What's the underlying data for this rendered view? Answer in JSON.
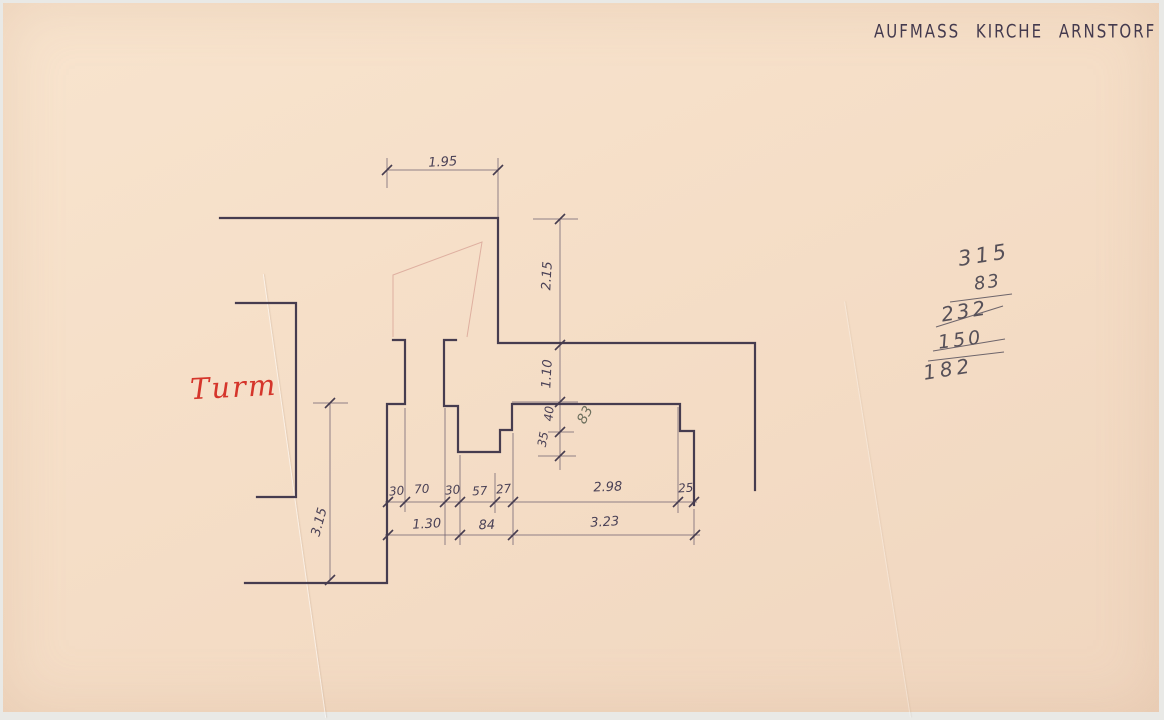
{
  "title": "AUFMASS KIRCHE ARNSTORF",
  "annotations": {
    "room_label": "Turm"
  },
  "calculation": {
    "lines": [
      {
        "text": "315"
      },
      {
        "text": "83"
      },
      {
        "text": "232"
      },
      {
        "text": "150"
      },
      {
        "text": "182"
      }
    ]
  },
  "colors": {
    "paper": "#f5dec7",
    "ink": "#463c4f",
    "dim_line": "#6e6070",
    "dim_text": "#4a4156",
    "pencil": "#57515c",
    "pencil_light": "#6e705e",
    "red": "#d5352b",
    "sketch": "#c4766e"
  },
  "drawing": {
    "walls": [
      [
        [
          220,
          218
        ],
        [
          498,
          218
        ],
        [
          498,
          343
        ],
        [
          755,
          343
        ],
        [
          755,
          490
        ]
      ],
      [
        [
          236,
          303
        ],
        [
          296,
          303
        ],
        [
          296,
          497
        ],
        [
          257,
          497
        ]
      ],
      [
        [
          393,
          340
        ],
        [
          405,
          340
        ],
        [
          405,
          404
        ],
        [
          387,
          404
        ],
        [
          387,
          583
        ],
        [
          245,
          583
        ]
      ],
      [
        [
          456,
          340
        ],
        [
          444,
          340
        ],
        [
          444,
          406
        ],
        [
          458,
          406
        ],
        [
          458,
          452
        ],
        [
          500,
          452
        ],
        [
          500,
          430
        ],
        [
          512,
          430
        ],
        [
          512,
          404
        ],
        [
          680,
          404
        ],
        [
          680,
          431
        ],
        [
          694,
          431
        ],
        [
          694,
          505
        ]
      ]
    ],
    "sketch": [
      [
        [
          393,
          337
        ],
        [
          393,
          275
        ],
        [
          482,
          242
        ],
        [
          467,
          337
        ]
      ]
    ],
    "dimension_lines": [
      [
        387,
        170,
        498,
        170
      ],
      [
        387,
        158,
        387,
        188
      ],
      [
        498,
        158,
        498,
        218
      ],
      [
        533,
        219,
        578,
        219
      ],
      [
        560,
        219,
        560,
        470
      ],
      [
        512,
        402,
        578,
        402
      ],
      [
        548,
        432,
        574,
        432
      ],
      [
        538,
        456,
        576,
        456
      ],
      [
        313,
        403,
        348,
        403
      ],
      [
        330,
        403,
        330,
        580
      ],
      [
        385,
        502,
        697,
        502
      ],
      [
        385,
        535,
        700,
        535
      ],
      [
        405,
        408,
        405,
        512
      ],
      [
        445,
        408,
        445,
        545
      ],
      [
        460,
        455,
        460,
        545
      ],
      [
        495,
        473,
        495,
        513
      ],
      [
        513,
        433,
        513,
        545
      ],
      [
        678,
        407,
        678,
        513
      ],
      [
        694,
        509,
        694,
        545
      ]
    ],
    "ticks": [
      [
        387,
        170
      ],
      [
        498,
        170
      ],
      [
        560,
        219
      ],
      [
        560,
        345
      ],
      [
        560,
        402
      ],
      [
        560,
        432
      ],
      [
        560,
        456
      ],
      [
        330,
        403
      ],
      [
        330,
        580
      ],
      [
        388,
        502
      ],
      [
        405,
        502
      ],
      [
        445,
        502
      ],
      [
        460,
        502
      ],
      [
        495,
        502
      ],
      [
        513,
        502
      ],
      [
        678,
        502
      ],
      [
        694,
        502
      ],
      [
        388,
        535
      ],
      [
        460,
        535
      ],
      [
        513,
        535
      ],
      [
        695,
        535
      ]
    ],
    "strikes": [
      [
        950,
        302,
        1012,
        294
      ],
      [
        936,
        327,
        1003,
        306
      ],
      [
        933,
        351,
        1005,
        339
      ],
      [
        928,
        361,
        1004,
        352
      ]
    ],
    "labels": [
      {
        "text": "1.95",
        "x": 443,
        "y": 166,
        "rotate": -3,
        "size": 13
      },
      {
        "text": "2.15",
        "x": 551,
        "y": 276,
        "rotate": -87,
        "size": 13
      },
      {
        "text": "1.10",
        "x": 551,
        "y": 374,
        "rotate": -87,
        "size": 13
      },
      {
        "text": "40",
        "x": 553,
        "y": 414,
        "rotate": -85,
        "size": 12
      },
      {
        "text": "35",
        "x": 547,
        "y": 440,
        "rotate": -80,
        "size": 12
      },
      {
        "text": "83",
        "x": 589,
        "y": 417,
        "rotate": -62,
        "size": 14,
        "color": "pencil_light"
      },
      {
        "text": "30",
        "x": 397,
        "y": 495,
        "rotate": -5,
        "size": 12
      },
      {
        "text": "70",
        "x": 422,
        "y": 493,
        "rotate": -3,
        "size": 12
      },
      {
        "text": "30",
        "x": 453,
        "y": 494,
        "rotate": -5,
        "size": 12
      },
      {
        "text": "57",
        "x": 480,
        "y": 495,
        "rotate": -3,
        "size": 12
      },
      {
        "text": "27",
        "x": 504,
        "y": 493,
        "rotate": -5,
        "size": 12
      },
      {
        "text": "2.98",
        "x": 608,
        "y": 491,
        "rotate": -2,
        "size": 13
      },
      {
        "text": "25",
        "x": 686,
        "y": 492,
        "rotate": -4,
        "size": 12
      },
      {
        "text": "1.30",
        "x": 427,
        "y": 528,
        "rotate": -3,
        "size": 13
      },
      {
        "text": "84",
        "x": 487,
        "y": 529,
        "rotate": -2,
        "size": 13
      },
      {
        "text": "3.23",
        "x": 605,
        "y": 526,
        "rotate": -3,
        "size": 13
      },
      {
        "text": "3.15",
        "x": 323,
        "y": 523,
        "rotate": -75,
        "size": 13
      }
    ]
  }
}
